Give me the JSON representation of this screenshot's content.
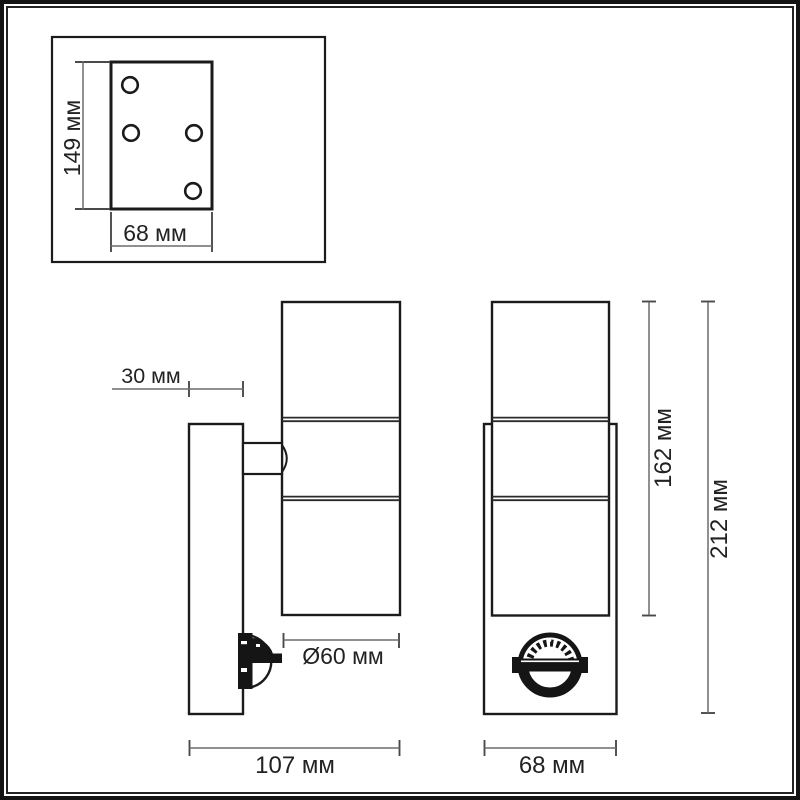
{
  "drawing": {
    "colors": {
      "outline": "#1b1b1b",
      "dimension_lines": "#6b6b6b",
      "label_text": "#222222",
      "background": "#ffffff"
    },
    "mounting_plate_view": {
      "height_label": "149 мм",
      "width_label": "68 мм"
    },
    "side_view": {
      "wall_offset_label": "30 мм",
      "diameter_label": "Ø60 мм",
      "depth_label": "107 мм"
    },
    "front_view": {
      "body_height_label": "162 мм",
      "total_height_label": "212 мм",
      "width_label": "68 мм"
    }
  }
}
